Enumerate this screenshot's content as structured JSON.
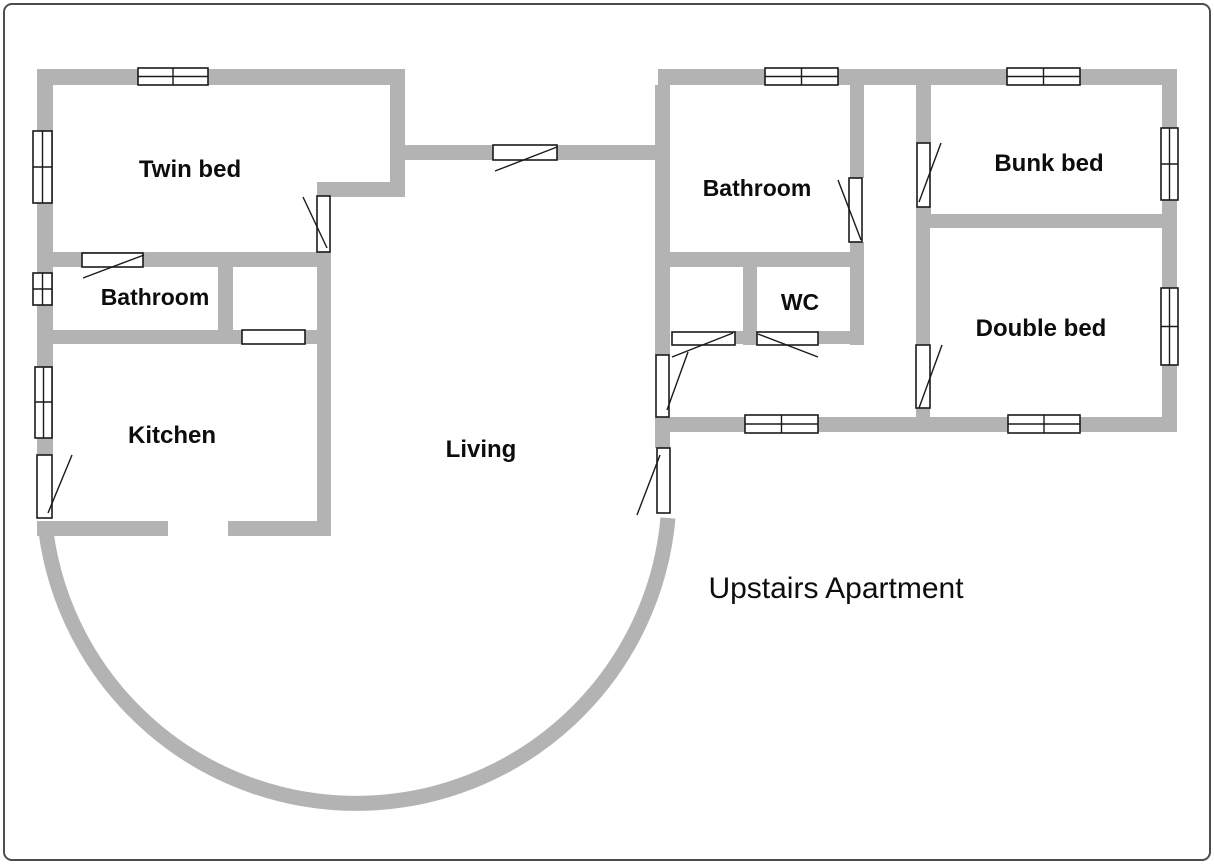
{
  "title": "Upstairs Apartment",
  "rooms": [
    {
      "id": "twin-bed",
      "label": "Twin bed"
    },
    {
      "id": "bathroom-left",
      "label": "Bathroom"
    },
    {
      "id": "kitchen",
      "label": "Kitchen"
    },
    {
      "id": "living",
      "label": "Living"
    },
    {
      "id": "bathroom-right",
      "label": "Bathroom"
    },
    {
      "id": "wc",
      "label": "WC"
    },
    {
      "id": "bunk-bed",
      "label": "Bunk bed"
    },
    {
      "id": "double-bed",
      "label": "Double bed"
    }
  ],
  "colors": {
    "wall": "#b3b3b3",
    "line": "#1a1a1a",
    "background": "#ffffff",
    "frame": "#4d4d4d"
  }
}
